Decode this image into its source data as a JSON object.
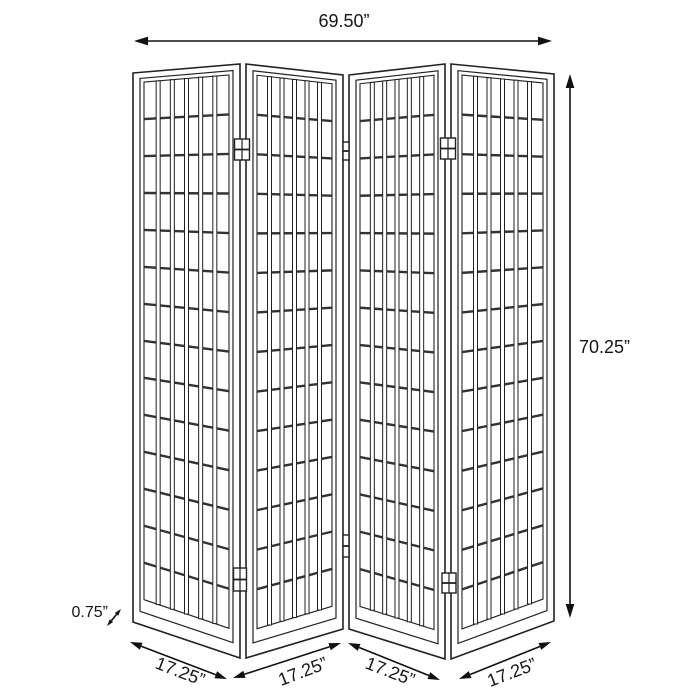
{
  "diagram": {
    "subject": "four-panel folding screen room divider dimension drawing",
    "panel_count": 4,
    "dimensions": {
      "width": "69.50”",
      "height": "70.25”",
      "thickness": "0.75”",
      "panel_widths": [
        "17.25”",
        "17.25”",
        "17.25”",
        "17.25”"
      ]
    },
    "lattice_grid": {
      "columns": 6,
      "rows": 14
    },
    "colors": {
      "line": "#222222",
      "rail": "#333333",
      "arrow": "#111111",
      "background": "#ffffff",
      "text": "#161616"
    }
  }
}
